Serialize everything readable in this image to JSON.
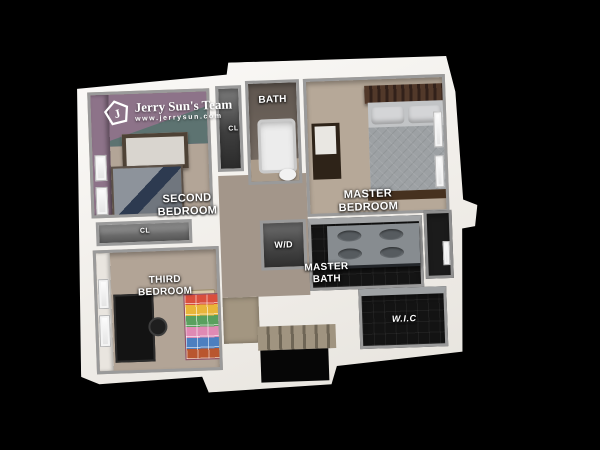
{
  "scene": {
    "description": "3D dollhouse-view floor plan render on black background",
    "background_color": "#000000"
  },
  "branding": {
    "team_name": "Jerry Sun's Team",
    "website": "www.jerrysun.com",
    "monogram": "J",
    "icon": "house-pentagon-icon"
  },
  "rooms": {
    "second_bedroom": {
      "label": "SECOND\nBEDROOM"
    },
    "bath": {
      "label": "BATH"
    },
    "closet_bath": {
      "label": "CL"
    },
    "master_bedroom": {
      "label": "MASTER\nBEDROOM"
    },
    "laundry": {
      "label": "W/D"
    },
    "master_bath": {
      "label": "MASTER\nBATH"
    },
    "walk_in_closet": {
      "label": "W.I.C"
    },
    "closet_hall": {
      "label": "CL"
    },
    "third_bedroom": {
      "label": "THIRD\nBEDROOM"
    }
  },
  "colors": {
    "background": "#000000",
    "outer_wall": "#f4f2ee",
    "inner_wall": "#9a9a9a",
    "carpet_tan": "#b3a597",
    "hall_carpet": "#a3968a",
    "accent_wall_purple": "#8d7389",
    "accent_wall_teal": "#5d7371",
    "dark_tile": "#141414",
    "bed_comforter_gray": "#9da1a4",
    "bed_frame_brown": "#46311f"
  }
}
